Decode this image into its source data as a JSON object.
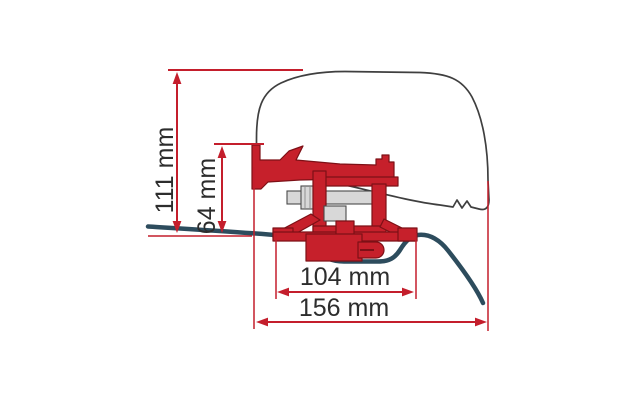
{
  "diagram": {
    "labels": {
      "overall_height": "111 mm",
      "bracket_height": "64 mm",
      "inner_width": "104 mm",
      "overall_width": "156 mm"
    },
    "colors": {
      "dimension_red": "#c41e2c",
      "bracket_red": "#c6202b",
      "bracket_outline": "#7d1016",
      "rail_blue": "#2d4c5d",
      "body_outline_gray": "#3f3f3f",
      "hardware_gray": "#d8d8d8",
      "label_text": "#2d2d2d",
      "background": "#ffffff"
    }
  }
}
